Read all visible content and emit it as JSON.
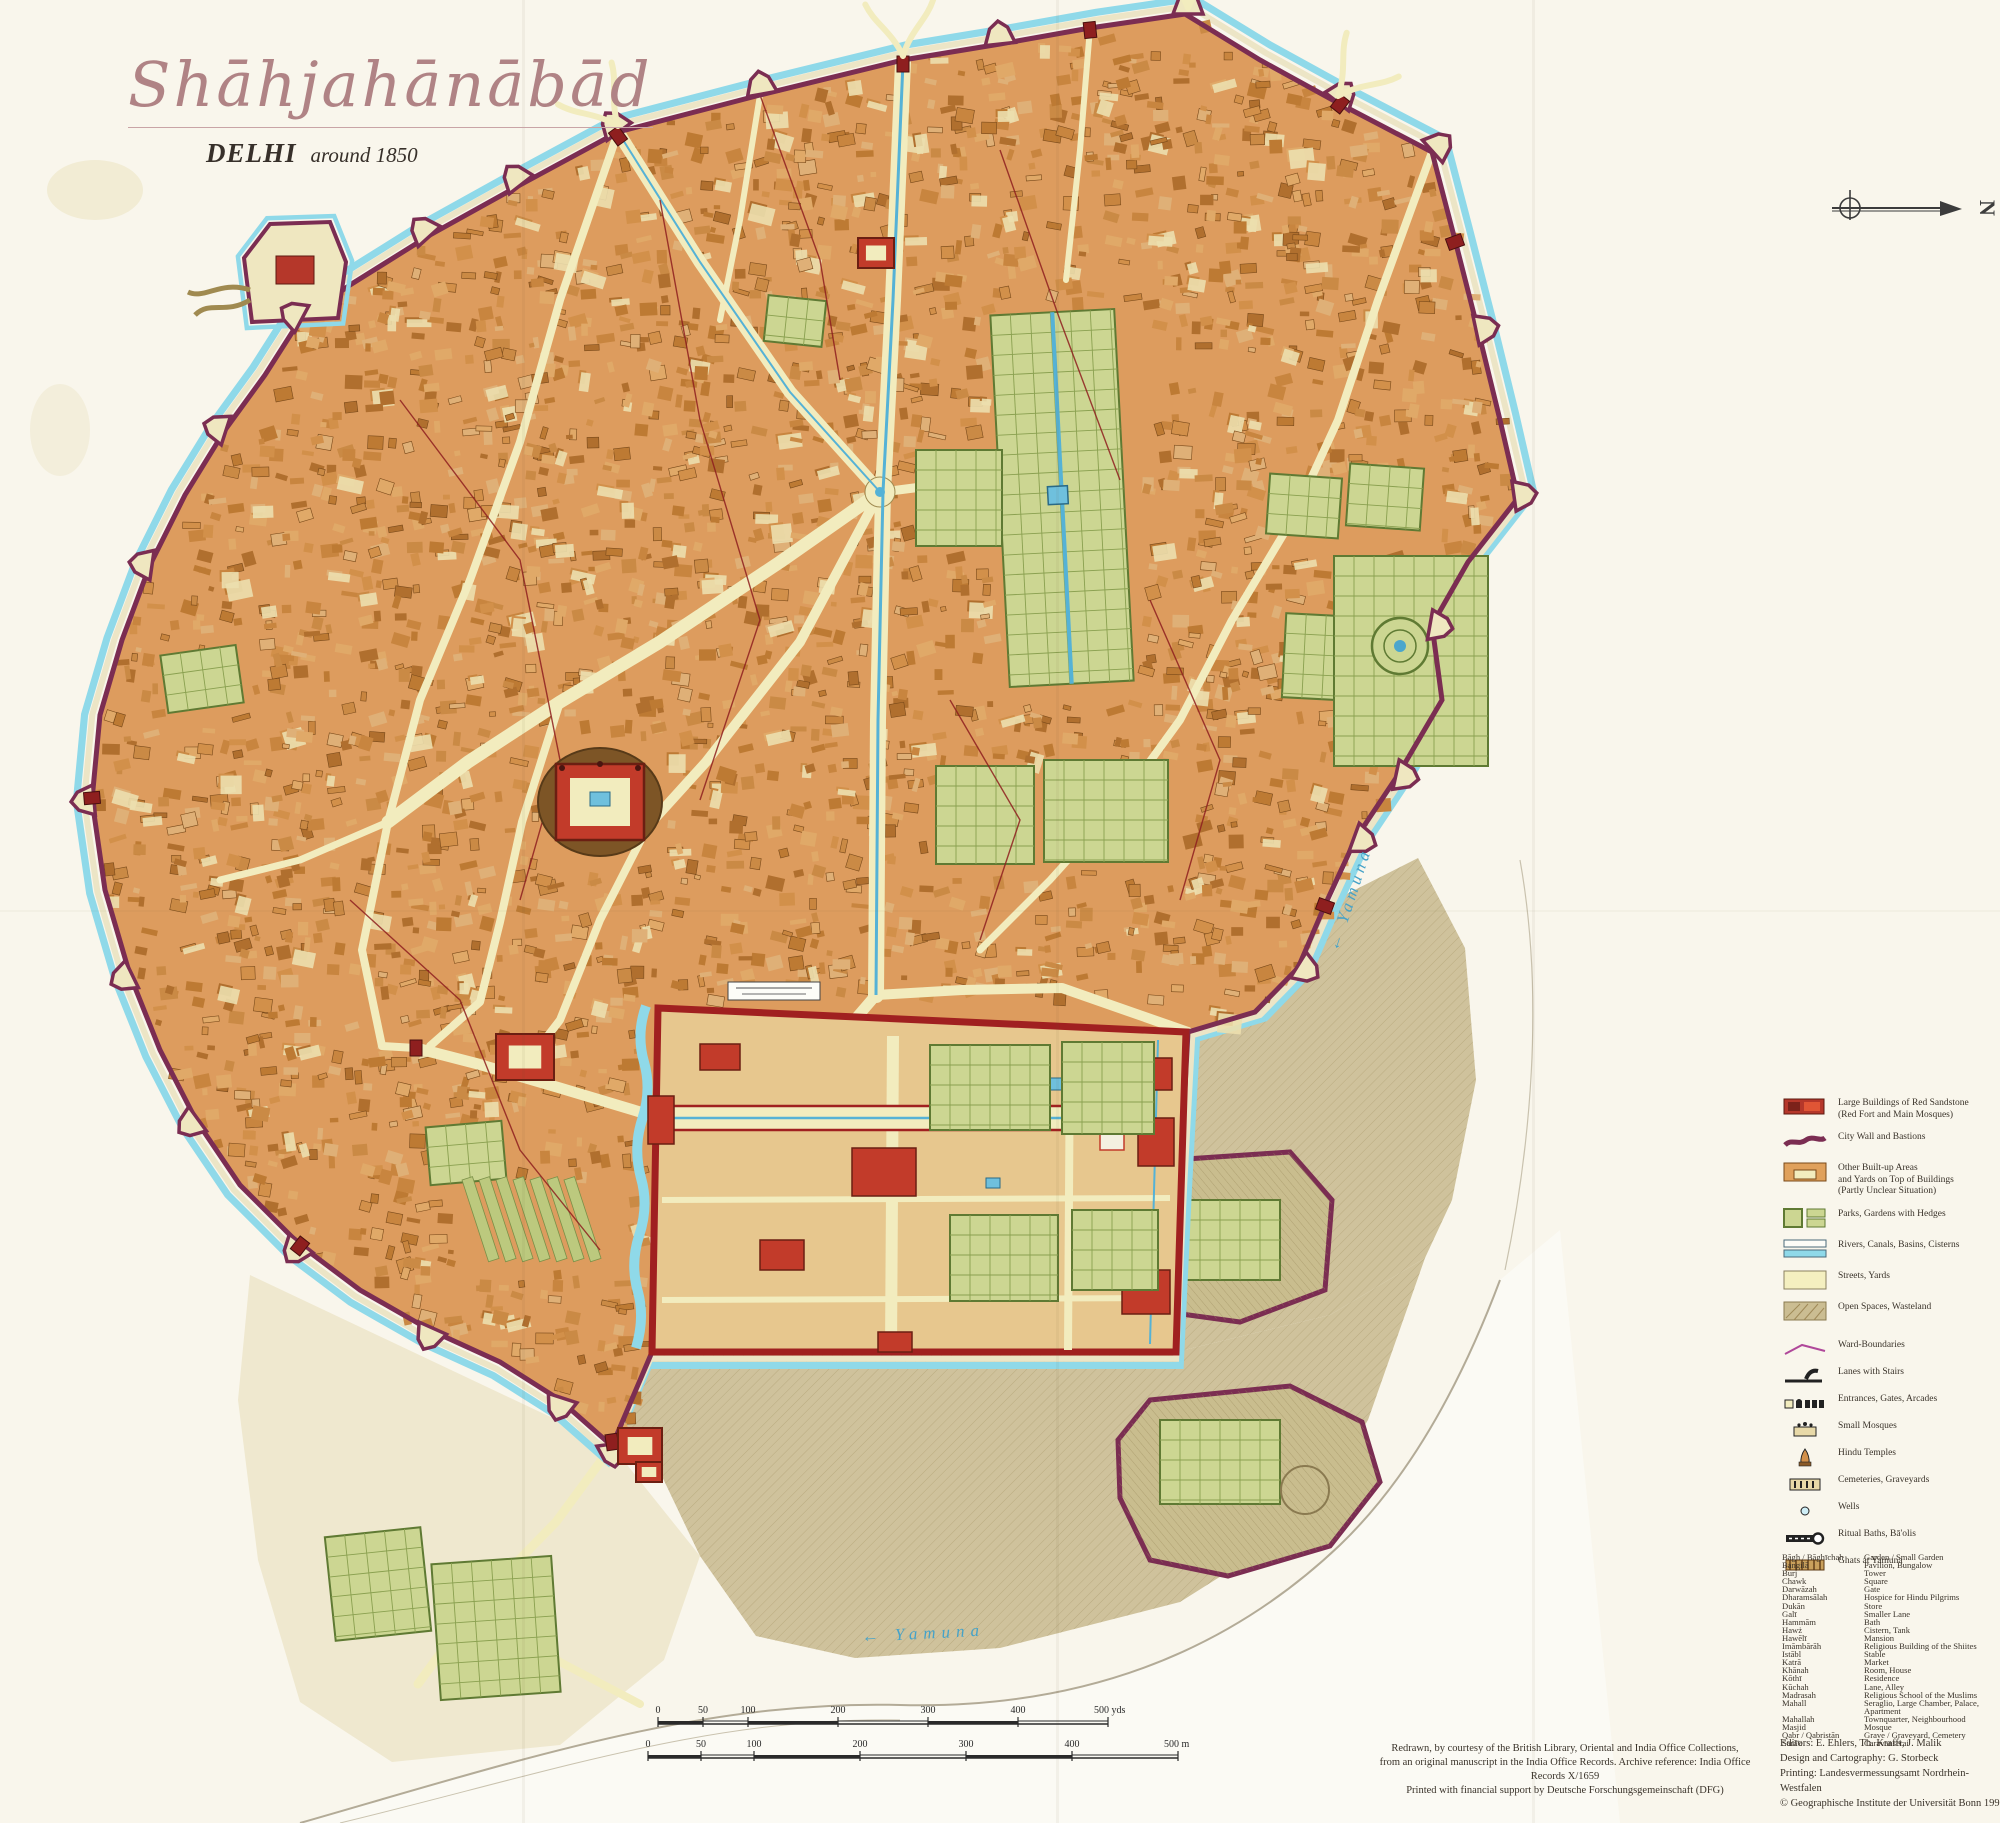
{
  "title": {
    "main": "Shāhjahānābād",
    "city": "DELHI",
    "subtitle": "around 1850"
  },
  "compass": {
    "label": "N"
  },
  "map_labels": {
    "river_right": "← Yamuna",
    "river_bottom": "← Yamuna"
  },
  "legend": {
    "items": [
      {
        "symbol": "red-sandstone-swatch",
        "lines": [
          "Large Buildings of Red Sandstone",
          "(Red Fort and Main Mosques)"
        ]
      },
      {
        "symbol": "city-wall-swatch",
        "lines": [
          "City Wall and Bastions"
        ]
      },
      {
        "symbol": "built-up-swatch",
        "lines": [
          "Other Built-up Areas",
          "and Yards on Top of Buildings",
          "(Partly Unclear Situation)"
        ]
      },
      {
        "symbol": "parks-swatch",
        "lines": [
          "Parks, Gardens with Hedges"
        ]
      },
      {
        "symbol": "rivers-swatch",
        "lines": [
          "Rivers, Canals, Basins, Cisterns"
        ]
      },
      {
        "symbol": "streets-swatch",
        "lines": [
          "Streets, Yards"
        ]
      },
      {
        "symbol": "open-spaces-swatch",
        "lines": [
          "Open Spaces, Wasteland"
        ]
      },
      {
        "symbol": "ward-boundary-swatch",
        "lines": [
          "Ward-Boundaries"
        ]
      },
      {
        "symbol": "lanes-stairs-swatch",
        "lines": [
          "Lanes with Stairs"
        ]
      },
      {
        "symbol": "entrances-swatch",
        "lines": [
          "Entrances, Gates, Arcades"
        ]
      },
      {
        "symbol": "small-mosques-swatch",
        "lines": [
          "Small Mosques"
        ]
      },
      {
        "symbol": "hindu-temples-swatch",
        "lines": [
          "Hindu Temples"
        ]
      },
      {
        "symbol": "cemeteries-swatch",
        "lines": [
          "Cemeteries, Graveyards"
        ]
      },
      {
        "symbol": "wells-swatch",
        "lines": [
          "Wells"
        ]
      },
      {
        "symbol": "ritual-baths-swatch",
        "lines": [
          "Ritual Baths, Bā'olis"
        ]
      },
      {
        "symbol": "ghats-swatch",
        "lines": [
          "Ghats at Yamuna"
        ]
      }
    ]
  },
  "glossary": [
    {
      "term": "Bāgh / Bāghīchah",
      "meaning": "Garden / Small Garden"
    },
    {
      "term": "Bangilā",
      "meaning": "Pavilion, Bungalow"
    },
    {
      "term": "Burj",
      "meaning": "Tower"
    },
    {
      "term": "Chawk",
      "meaning": "Square"
    },
    {
      "term": "Darwāzah",
      "meaning": "Gate"
    },
    {
      "term": "Dharamsālah",
      "meaning": "Hospice for Hindu Pilgrims"
    },
    {
      "term": "Dukān",
      "meaning": "Store"
    },
    {
      "term": "Galī",
      "meaning": "Smaller Lane"
    },
    {
      "term": "Hammām",
      "meaning": "Bath"
    },
    {
      "term": "Hawż",
      "meaning": "Cistern, Tank"
    },
    {
      "term": "Hawēlī",
      "meaning": "Mansion"
    },
    {
      "term": "Imāmbārāh",
      "meaning": "Religious Building of the Shiites"
    },
    {
      "term": "Istābl",
      "meaning": "Stable"
    },
    {
      "term": "Katrā",
      "meaning": "Market"
    },
    {
      "term": "Khānah",
      "meaning": "Room, House"
    },
    {
      "term": "Kōthī",
      "meaning": "Residence"
    },
    {
      "term": "Kūchah",
      "meaning": "Lane, Alley"
    },
    {
      "term": "Madrasah",
      "meaning": "Religious School of the Muslims"
    },
    {
      "term": "Mahall",
      "meaning": "Seraglio, Large Chamber, Palace, Apartment"
    },
    {
      "term": "Mahallah",
      "meaning": "Townquarter, Neighbourhood"
    },
    {
      "term": "Masjid",
      "meaning": "Mosque"
    },
    {
      "term": "Qabr / Qabristān",
      "meaning": "Grave / Graveyard, Cemetery"
    },
    {
      "term": "Sarā'e",
      "meaning": "Caravanserai"
    }
  ],
  "scale": {
    "yds_ticks": [
      "0",
      "50",
      "100",
      "200",
      "300",
      "400",
      "500 yds"
    ],
    "yds_values": [
      0,
      50,
      100,
      200,
      300,
      400,
      500
    ],
    "m_ticks": [
      "0",
      "50",
      "100",
      "200",
      "300",
      "400",
      "500 m"
    ],
    "m_values": [
      0,
      50,
      100,
      200,
      300,
      400,
      500
    ]
  },
  "credits": {
    "source_lines": [
      "Redrawn, by courtesy of the British Library, Oriental and India Office Collections,",
      "from an original manuscript in the India Office Records. Archive reference: India Office Records X/1659",
      "Printed with financial support by Deutsche Forschungsgemeinschaft (DFG)"
    ],
    "imprint_lines": [
      "Editors: E. Ehlers, Th. Krafft, J. Malik",
      "Design and Cartography: G. Storbeck",
      "Printing: Landesvermessungsamt Nordrhein-Westfalen",
      "© Geographische Institute der Universität Bonn 1992"
    ]
  },
  "colors": {
    "paper": "#f9f6ec",
    "built_up": "#d6954f",
    "street": "#f2ecbe",
    "wall": "#7b2d52",
    "moat": "#8fd9e9",
    "canal": "#55b2d6",
    "park": "#ccd692",
    "park_line": "#5f7a33",
    "red_sandstone": "#c23b2a",
    "fort_wall": "#a02020",
    "sand": "#cfc29c",
    "river_label": "#45a2c8",
    "ward_line": "#8e1f1f"
  }
}
